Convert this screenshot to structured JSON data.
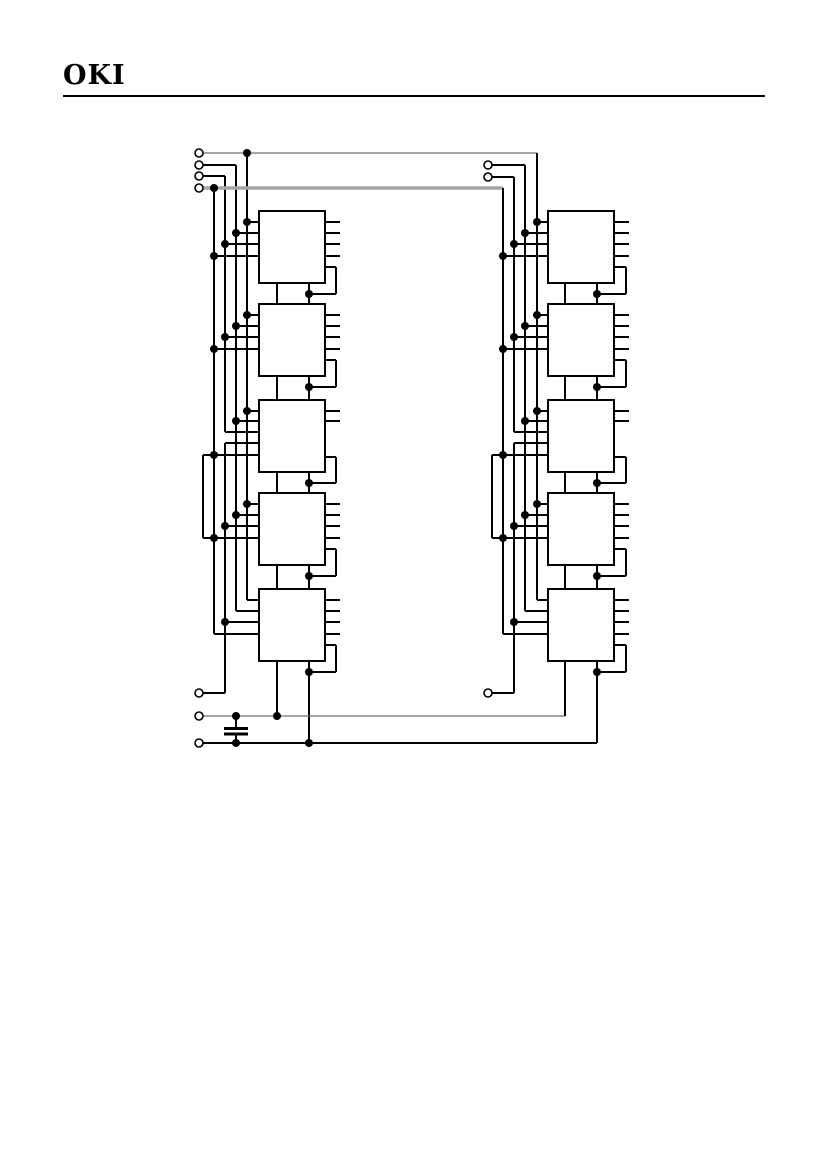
{
  "header": {
    "logo": "OKI"
  },
  "diagram": {
    "canvas": {
      "width": 826,
      "height": 1169
    },
    "dot_radius": 4,
    "terminal_radius": 4,
    "styles": {
      "k": {
        "color": "#000000",
        "width": 2
      },
      "g": {
        "color": "#6f6f6f",
        "width": 1.3
      },
      "G": {
        "color": "#a6a6a6",
        "width": 3.5
      }
    },
    "blocks": [
      [
        259,
        211,
        66,
        72
      ],
      [
        259,
        304,
        66,
        72
      ],
      [
        259,
        400,
        66,
        72
      ],
      [
        259,
        493,
        66,
        72
      ],
      [
        259,
        589,
        66,
        72
      ],
      [
        548,
        211,
        66,
        72
      ],
      [
        548,
        304,
        66,
        72
      ],
      [
        548,
        400,
        66,
        72
      ],
      [
        548,
        493,
        66,
        72
      ],
      [
        548,
        589,
        66,
        72
      ]
    ],
    "bars": [
      [
        224,
        727,
        24,
        3
      ],
      [
        224,
        732.5,
        24,
        3
      ]
    ],
    "lines": [
      [
        247,
        222,
        259,
        222,
        "k"
      ],
      [
        236,
        233,
        259,
        233,
        "k"
      ],
      [
        225,
        244,
        259,
        244,
        "k"
      ],
      [
        214,
        256,
        259,
        256,
        "k"
      ],
      [
        247,
        315,
        259,
        315,
        "k"
      ],
      [
        236,
        326,
        259,
        326,
        "k"
      ],
      [
        225,
        337,
        259,
        337,
        "k"
      ],
      [
        214,
        349,
        259,
        349,
        "k"
      ],
      [
        247,
        411,
        259,
        411,
        "k"
      ],
      [
        236,
        421,
        259,
        421,
        "k"
      ],
      [
        225,
        432,
        259,
        432,
        "k"
      ],
      [
        225,
        443,
        259,
        443,
        "k"
      ],
      [
        203,
        455,
        259,
        455,
        "k"
      ],
      [
        247,
        504,
        259,
        504,
        "k"
      ],
      [
        236,
        515,
        259,
        515,
        "k"
      ],
      [
        225,
        526,
        259,
        526,
        "k"
      ],
      [
        203,
        538,
        259,
        538,
        "k"
      ],
      [
        247,
        600,
        259,
        600,
        "k"
      ],
      [
        236,
        611,
        259,
        611,
        "k"
      ],
      [
        225,
        622,
        259,
        622,
        "k"
      ],
      [
        214,
        634,
        259,
        634,
        "k"
      ],
      [
        247,
        153,
        247,
        600,
        "k"
      ],
      [
        236,
        165,
        236,
        611,
        "k"
      ],
      [
        225,
        176,
        225,
        432,
        "k"
      ],
      [
        225,
        443,
        225,
        693,
        "k"
      ],
      [
        214,
        188,
        214,
        634,
        "k"
      ],
      [
        203,
        455,
        203,
        538,
        "k"
      ],
      [
        325,
        222,
        340,
        222,
        "k"
      ],
      [
        325,
        233,
        340,
        233,
        "k"
      ],
      [
        325,
        244,
        340,
        244,
        "k"
      ],
      [
        325,
        256,
        340,
        256,
        "k"
      ],
      [
        325,
        315,
        340,
        315,
        "k"
      ],
      [
        325,
        326,
        340,
        326,
        "k"
      ],
      [
        325,
        337,
        340,
        337,
        "k"
      ],
      [
        325,
        349,
        340,
        349,
        "k"
      ],
      [
        325,
        411,
        340,
        411,
        "k"
      ],
      [
        325,
        421,
        340,
        421,
        "k"
      ],
      [
        325,
        504,
        340,
        504,
        "k"
      ],
      [
        325,
        515,
        340,
        515,
        "k"
      ],
      [
        325,
        526,
        340,
        526,
        "k"
      ],
      [
        325,
        538,
        340,
        538,
        "k"
      ],
      [
        325,
        600,
        340,
        600,
        "k"
      ],
      [
        325,
        611,
        340,
        611,
        "k"
      ],
      [
        325,
        622,
        340,
        622,
        "k"
      ],
      [
        325,
        634,
        340,
        634,
        "k"
      ],
      [
        325,
        267,
        336,
        267,
        "k"
      ],
      [
        336,
        267,
        336,
        294,
        "k"
      ],
      [
        309,
        294,
        336,
        294,
        "k"
      ],
      [
        325,
        360,
        336,
        360,
        "k"
      ],
      [
        336,
        360,
        336,
        387,
        "k"
      ],
      [
        309,
        387,
        336,
        387,
        "k"
      ],
      [
        325,
        457,
        336,
        457,
        "k"
      ],
      [
        336,
        457,
        336,
        483,
        "k"
      ],
      [
        309,
        483,
        336,
        483,
        "k"
      ],
      [
        325,
        549,
        336,
        549,
        "k"
      ],
      [
        336,
        549,
        336,
        576,
        "k"
      ],
      [
        309,
        576,
        336,
        576,
        "k"
      ],
      [
        325,
        645,
        336,
        645,
        "k"
      ],
      [
        336,
        645,
        336,
        672,
        "k"
      ],
      [
        309,
        672,
        336,
        672,
        "k"
      ],
      [
        277,
        283,
        277,
        304,
        "k"
      ],
      [
        309,
        283,
        309,
        304,
        "k"
      ],
      [
        277,
        376,
        277,
        400,
        "k"
      ],
      [
        309,
        376,
        309,
        400,
        "k"
      ],
      [
        277,
        472,
        277,
        493,
        "k"
      ],
      [
        309,
        472,
        309,
        493,
        "k"
      ],
      [
        277,
        565,
        277,
        589,
        "k"
      ],
      [
        309,
        565,
        309,
        589,
        "k"
      ],
      [
        277,
        661,
        277,
        716,
        "k"
      ],
      [
        309,
        661,
        309,
        743,
        "k"
      ],
      [
        203,
        153,
        537,
        153,
        "g"
      ],
      [
        203,
        165,
        236,
        165,
        "k"
      ],
      [
        203,
        176,
        225,
        176,
        "k"
      ],
      [
        203,
        188,
        503,
        188,
        "G"
      ],
      [
        203,
        693,
        225,
        693,
        "k"
      ],
      [
        203,
        716,
        565,
        716,
        "g"
      ],
      [
        203,
        743,
        597,
        743,
        "k"
      ],
      [
        236,
        716,
        236,
        727,
        "k"
      ],
      [
        236,
        735.5,
        236,
        743,
        "k"
      ],
      [
        537,
        222,
        548,
        222,
        "k"
      ],
      [
        525,
        233,
        548,
        233,
        "k"
      ],
      [
        514,
        244,
        548,
        244,
        "k"
      ],
      [
        503,
        256,
        548,
        256,
        "k"
      ],
      [
        537,
        315,
        548,
        315,
        "k"
      ],
      [
        525,
        326,
        548,
        326,
        "k"
      ],
      [
        514,
        337,
        548,
        337,
        "k"
      ],
      [
        503,
        349,
        548,
        349,
        "k"
      ],
      [
        537,
        411,
        548,
        411,
        "k"
      ],
      [
        525,
        421,
        548,
        421,
        "k"
      ],
      [
        514,
        432,
        548,
        432,
        "k"
      ],
      [
        514,
        443,
        548,
        443,
        "k"
      ],
      [
        492,
        455,
        548,
        455,
        "k"
      ],
      [
        537,
        504,
        548,
        504,
        "k"
      ],
      [
        525,
        515,
        548,
        515,
        "k"
      ],
      [
        514,
        526,
        548,
        526,
        "k"
      ],
      [
        492,
        538,
        548,
        538,
        "k"
      ],
      [
        537,
        600,
        548,
        600,
        "k"
      ],
      [
        525,
        611,
        548,
        611,
        "k"
      ],
      [
        514,
        622,
        548,
        622,
        "k"
      ],
      [
        503,
        634,
        548,
        634,
        "k"
      ],
      [
        537,
        153,
        537,
        600,
        "k"
      ],
      [
        525,
        165,
        525,
        611,
        "k"
      ],
      [
        514,
        177,
        514,
        432,
        "k"
      ],
      [
        514,
        443,
        514,
        693,
        "k"
      ],
      [
        503,
        188,
        503,
        634,
        "k"
      ],
      [
        492,
        455,
        492,
        538,
        "k"
      ],
      [
        614,
        222,
        629,
        222,
        "k"
      ],
      [
        614,
        233,
        629,
        233,
        "k"
      ],
      [
        614,
        244,
        629,
        244,
        "k"
      ],
      [
        614,
        256,
        629,
        256,
        "k"
      ],
      [
        614,
        315,
        629,
        315,
        "k"
      ],
      [
        614,
        326,
        629,
        326,
        "k"
      ],
      [
        614,
        337,
        629,
        337,
        "k"
      ],
      [
        614,
        349,
        629,
        349,
        "k"
      ],
      [
        614,
        411,
        629,
        411,
        "k"
      ],
      [
        614,
        421,
        629,
        421,
        "k"
      ],
      [
        614,
        504,
        629,
        504,
        "k"
      ],
      [
        614,
        515,
        629,
        515,
        "k"
      ],
      [
        614,
        526,
        629,
        526,
        "k"
      ],
      [
        614,
        538,
        629,
        538,
        "k"
      ],
      [
        614,
        600,
        629,
        600,
        "k"
      ],
      [
        614,
        611,
        629,
        611,
        "k"
      ],
      [
        614,
        622,
        629,
        622,
        "k"
      ],
      [
        614,
        634,
        629,
        634,
        "k"
      ],
      [
        614,
        267,
        626,
        267,
        "k"
      ],
      [
        626,
        267,
        626,
        294,
        "k"
      ],
      [
        597,
        294,
        626,
        294,
        "k"
      ],
      [
        614,
        360,
        626,
        360,
        "k"
      ],
      [
        626,
        360,
        626,
        387,
        "k"
      ],
      [
        597,
        387,
        626,
        387,
        "k"
      ],
      [
        614,
        457,
        626,
        457,
        "k"
      ],
      [
        626,
        457,
        626,
        483,
        "k"
      ],
      [
        597,
        483,
        626,
        483,
        "k"
      ],
      [
        614,
        549,
        626,
        549,
        "k"
      ],
      [
        626,
        549,
        626,
        576,
        "k"
      ],
      [
        597,
        576,
        626,
        576,
        "k"
      ],
      [
        614,
        645,
        626,
        645,
        "k"
      ],
      [
        626,
        645,
        626,
        672,
        "k"
      ],
      [
        597,
        672,
        626,
        672,
        "k"
      ],
      [
        565,
        283,
        565,
        304,
        "k"
      ],
      [
        597,
        283,
        597,
        304,
        "k"
      ],
      [
        565,
        376,
        565,
        400,
        "k"
      ],
      [
        597,
        376,
        597,
        400,
        "k"
      ],
      [
        565,
        472,
        565,
        493,
        "k"
      ],
      [
        597,
        472,
        597,
        493,
        "k"
      ],
      [
        565,
        565,
        565,
        589,
        "k"
      ],
      [
        597,
        565,
        597,
        589,
        "k"
      ],
      [
        565,
        661,
        565,
        716,
        "k"
      ],
      [
        597,
        661,
        597,
        743,
        "k"
      ],
      [
        492,
        165,
        525,
        165,
        "k"
      ],
      [
        492,
        177,
        514,
        177,
        "k"
      ],
      [
        492,
        693,
        514,
        693,
        "k"
      ]
    ],
    "dots": [
      [
        247,
        153
      ],
      [
        214,
        188
      ],
      [
        247,
        222
      ],
      [
        236,
        233
      ],
      [
        225,
        244
      ],
      [
        214,
        256
      ],
      [
        247,
        315
      ],
      [
        236,
        326
      ],
      [
        225,
        337
      ],
      [
        214,
        349
      ],
      [
        247,
        411
      ],
      [
        236,
        421
      ],
      [
        214,
        455
      ],
      [
        247,
        504
      ],
      [
        236,
        515
      ],
      [
        225,
        526
      ],
      [
        214,
        538
      ],
      [
        225,
        622
      ],
      [
        309,
        294
      ],
      [
        309,
        387
      ],
      [
        309,
        483
      ],
      [
        309,
        576
      ],
      [
        309,
        672
      ],
      [
        236,
        716
      ],
      [
        277,
        716
      ],
      [
        236,
        743
      ],
      [
        309,
        743
      ],
      [
        537,
        222
      ],
      [
        525,
        233
      ],
      [
        514,
        244
      ],
      [
        503,
        256
      ],
      [
        537,
        315
      ],
      [
        525,
        326
      ],
      [
        514,
        337
      ],
      [
        503,
        349
      ],
      [
        537,
        411
      ],
      [
        525,
        421
      ],
      [
        503,
        455
      ],
      [
        537,
        504
      ],
      [
        525,
        515
      ],
      [
        514,
        526
      ],
      [
        503,
        538
      ],
      [
        514,
        622
      ],
      [
        597,
        294
      ],
      [
        597,
        387
      ],
      [
        597,
        483
      ],
      [
        597,
        576
      ],
      [
        597,
        672
      ]
    ],
    "terminals": [
      [
        199,
        153
      ],
      [
        199,
        165
      ],
      [
        199,
        176
      ],
      [
        199,
        188
      ],
      [
        199,
        693
      ],
      [
        199,
        716
      ],
      [
        199,
        743
      ],
      [
        488,
        165
      ],
      [
        488,
        177
      ],
      [
        488,
        693
      ]
    ]
  }
}
